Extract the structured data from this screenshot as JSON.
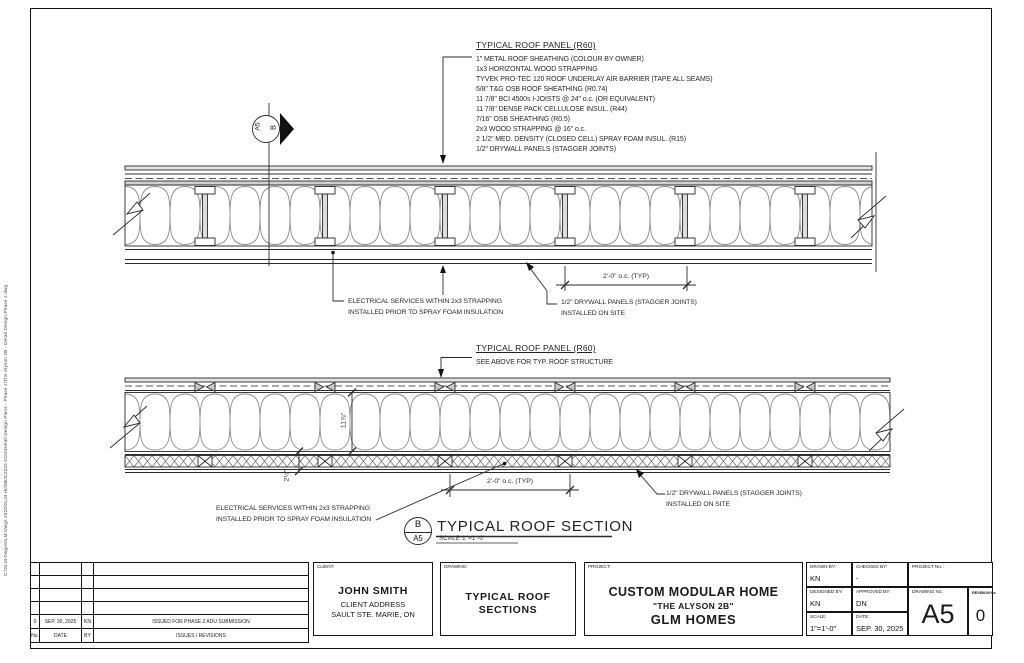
{
  "sheet": {
    "stamp": "C:\\GLM Dwgs\\GLM Dwgs 2025\\GLM HOMES\\2025 ADU\\Detail Design Plans - Phase 2\\The Alyson 2B - Detail Design Phase 2.dwg"
  },
  "callout": {
    "letter": "B",
    "sheet": "A5"
  },
  "specs": {
    "top": {
      "title": "TYPICAL ROOF PANEL (R60)",
      "lines": [
        "1\" METAL ROOF SHEATHING (COLOUR BY OWNER)",
        "1x3 HORIZONTAL WOOD STRAPPING",
        "TYVEK PRO-TEC 120 ROOF UNDERLAY AIR BARRIER (TAPE ALL SEAMS)",
        "5/8\" T&G OSB ROOF SHEATHING (R0.74)",
        "11 7/8\" BCI 4500s I-JOISTS @ 24\" o.c. (OR EQUIVALENT)",
        "11 7/8\" DENSE PACK CELLULOSE INSUL. (R44)",
        "7/16\" OSB SHEATHING (R0.5)",
        "2x3 WOOD STRAPPING @ 16\" o.c.",
        "2 1/2\" MED. DENSITY (CLOSED CELL) SPRAY FOAM INSUL. (R15)",
        "1/2\" DRYWALL PANELS (STAGGER JOINTS)"
      ]
    },
    "bottom": {
      "title": "TYPICAL ROOF PANEL (R60)",
      "subtitle": "SEE ABOVE FOR TYP. ROOF STRUCTURE"
    }
  },
  "notes": {
    "electrical_line1": "ELECTRICAL SERVICES WITHIN 2x3 STRAPPING",
    "electrical_line2": "INSTALLED PRIOR TO SPRAY FOAM INSULATION",
    "drywall_line1": "1/2\" DRYWALL PANELS (STAGGER JOINTS)",
    "drywall_line2": "INSTALLED ON SITE"
  },
  "dims": {
    "spacing": "2'-0\" o.c. (TYP)",
    "joist_depth": "11⅞\"",
    "foam_depth": "2½\""
  },
  "title": {
    "name": "TYPICAL ROOF SECTION",
    "scale": "SCALE  1\"=1'-0\""
  },
  "titleblock": {
    "revisions": {
      "header": {
        "no": "No.",
        "date": "DATE",
        "by": "BY",
        "desc": "ISSUES / REVISIONS"
      },
      "row": {
        "no": "0",
        "date": "SEP. 30, 2025",
        "by": "KN",
        "desc": "ISSUED FOR PHASE 2 ADU SUBMISSION"
      }
    },
    "client": {
      "label": "CLIENT:",
      "name": "JOHN SMITH",
      "address1": "CLIENT ADDRESS",
      "address2": "SAULT STE. MARIE, ON"
    },
    "drawing": {
      "label": "DRAWING:",
      "line1": "TYPICAL ROOF",
      "line2": "SECTIONS"
    },
    "project": {
      "label": "PROJECT:",
      "line1": "CUSTOM MODULAR HOME",
      "line2": "\"THE ALYSON 2B\"",
      "line3": "GLM HOMES"
    },
    "meta": {
      "drawn_label": "DRAWN BY:",
      "drawn": "KN",
      "checked_label": "CHECKED BY:",
      "checked": "-",
      "designed_label": "DESIGNED BY:",
      "designed": "KN",
      "approved_label": "APPROVED BY:",
      "approved": "DN",
      "scale_label": "SCALE:",
      "scale": "1\"=1'-0\"",
      "date_label": "DATE:",
      "date": "SEP. 30, 2025",
      "project_no_label": "PROJECT No. :",
      "drawing_no_label": "DRAWING No.",
      "drawing_no": "A5",
      "revision_label": "REVISION No.",
      "revision": "0"
    }
  }
}
